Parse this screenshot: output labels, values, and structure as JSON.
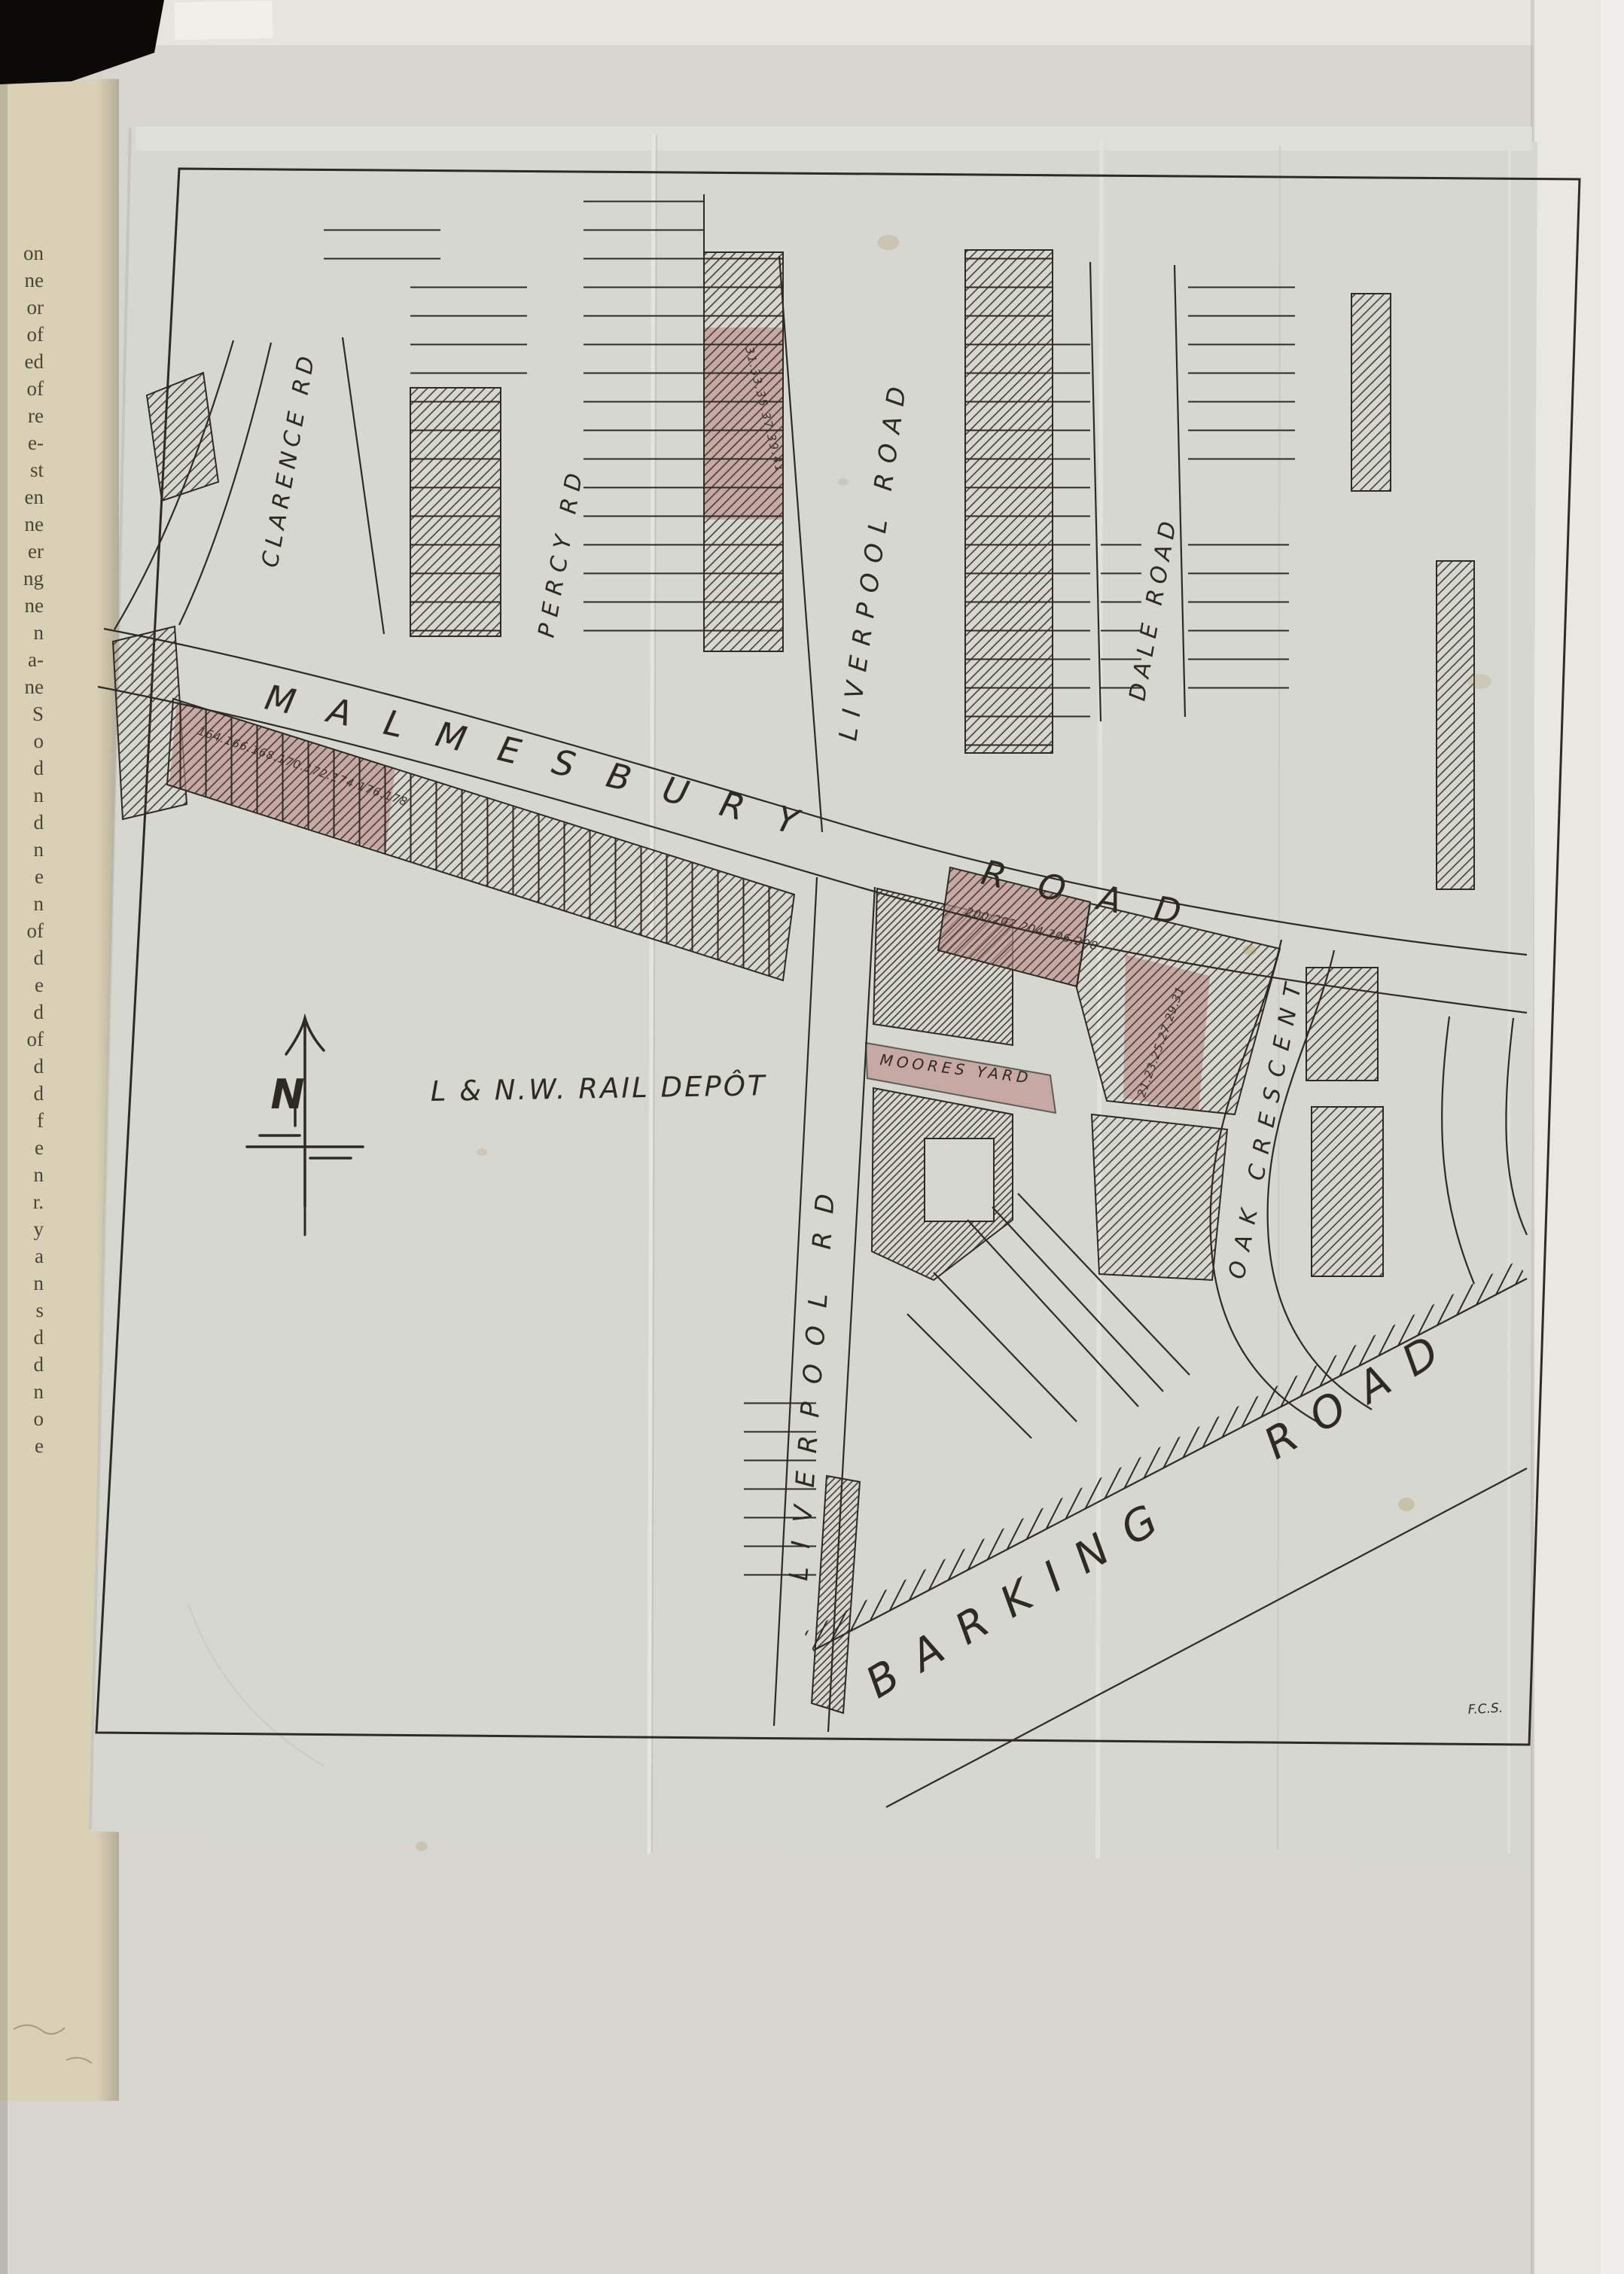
{
  "scan": {
    "credit": "F.C.S.",
    "book_edge_fragments": [
      "on",
      "ne",
      "or",
      "of",
      "ed",
      "of",
      "re",
      "e-",
      "st",
      "en",
      "ne",
      "er",
      "ng",
      "ne",
      "n",
      "a-",
      "ne",
      "S",
      "o",
      "d",
      "n",
      "d",
      "n",
      "e",
      "n",
      "of",
      "d",
      "e",
      "d",
      "of",
      "d",
      "d",
      "f",
      "e",
      "n",
      "r.",
      "y",
      "a",
      "n",
      "s",
      "d",
      "d",
      "n",
      "o",
      "e"
    ]
  },
  "map": {
    "roads": {
      "malmesbury": "MALMESBURY ROAD",
      "clarence": "CLARENCE RD",
      "percy": "PERCY RD",
      "liverpool_north": "LIVERPOOL ROAD",
      "dale": "DALE ROAD",
      "liverpool_south": "LIVERPOOL RD",
      "oak_crescent": "OAK CRESCENT",
      "barking": "BARKING ROAD"
    },
    "places": {
      "rail_depot": "L & N.W. RAIL DEPÔT",
      "moores_yard": "MOORES YARD"
    },
    "house_numbers": {
      "malmesbury_west_terrace": "164.166.168.170.172.174.176.178",
      "liverpool_road_terrace": "31.33.35.37.39.41",
      "malmesbury_east_terrace": "200.202.204.206.208",
      "oak_crescent_terrace": "21.23.25.27.29.31"
    },
    "compass_north": "N",
    "colors": {
      "ink": "#2f2a23",
      "sheet": "#d6d7cf",
      "highlight": "#c09690",
      "book_page": "#d9d1b6"
    }
  }
}
